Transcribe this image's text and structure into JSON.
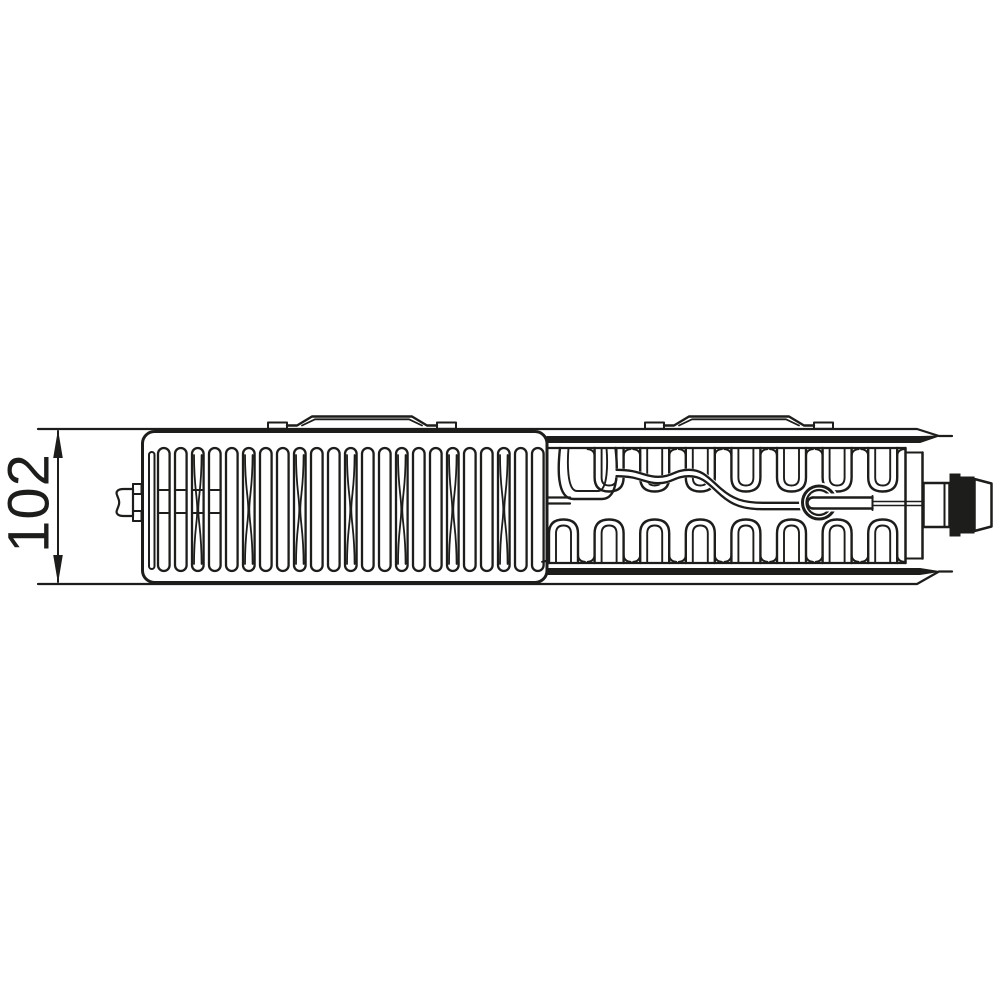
{
  "page": {
    "background": "#ffffff"
  },
  "colors": {
    "line": "#1d1d1b",
    "fill_dark": "#1d1d1b",
    "white": "#ffffff"
  },
  "dimension": {
    "label": "102"
  },
  "drawing": {
    "grille_slots": {
      "count": 23,
      "x0": 158,
      "pitch": 17.0,
      "width": 11.6,
      "y_top": 448,
      "y_bottom": 571,
      "crossed": [
        2,
        5,
        8,
        11,
        14,
        17,
        20
      ],
      "tie_slots": [
        0,
        1,
        2,
        3
      ],
      "tie_ys": [
        490,
        513
      ],
      "narrow_slot": {
        "x": 149,
        "y": 452,
        "width": 5.5,
        "height": 117
      }
    },
    "brackets": {
      "positions_x": [
        268,
        645
      ]
    },
    "convector_fins": {
      "start_center": 563.5,
      "pitch": 45.6,
      "count": 8,
      "outer_half": 14.5,
      "inner_half": 7.5,
      "top": {
        "base": 448,
        "outer_end": 491.5,
        "inner_end": 485.5,
        "skip_first": true
      },
      "bottom": {
        "base": 563,
        "outer_end": 519.5,
        "inner_end": 525.5
      }
    }
  }
}
